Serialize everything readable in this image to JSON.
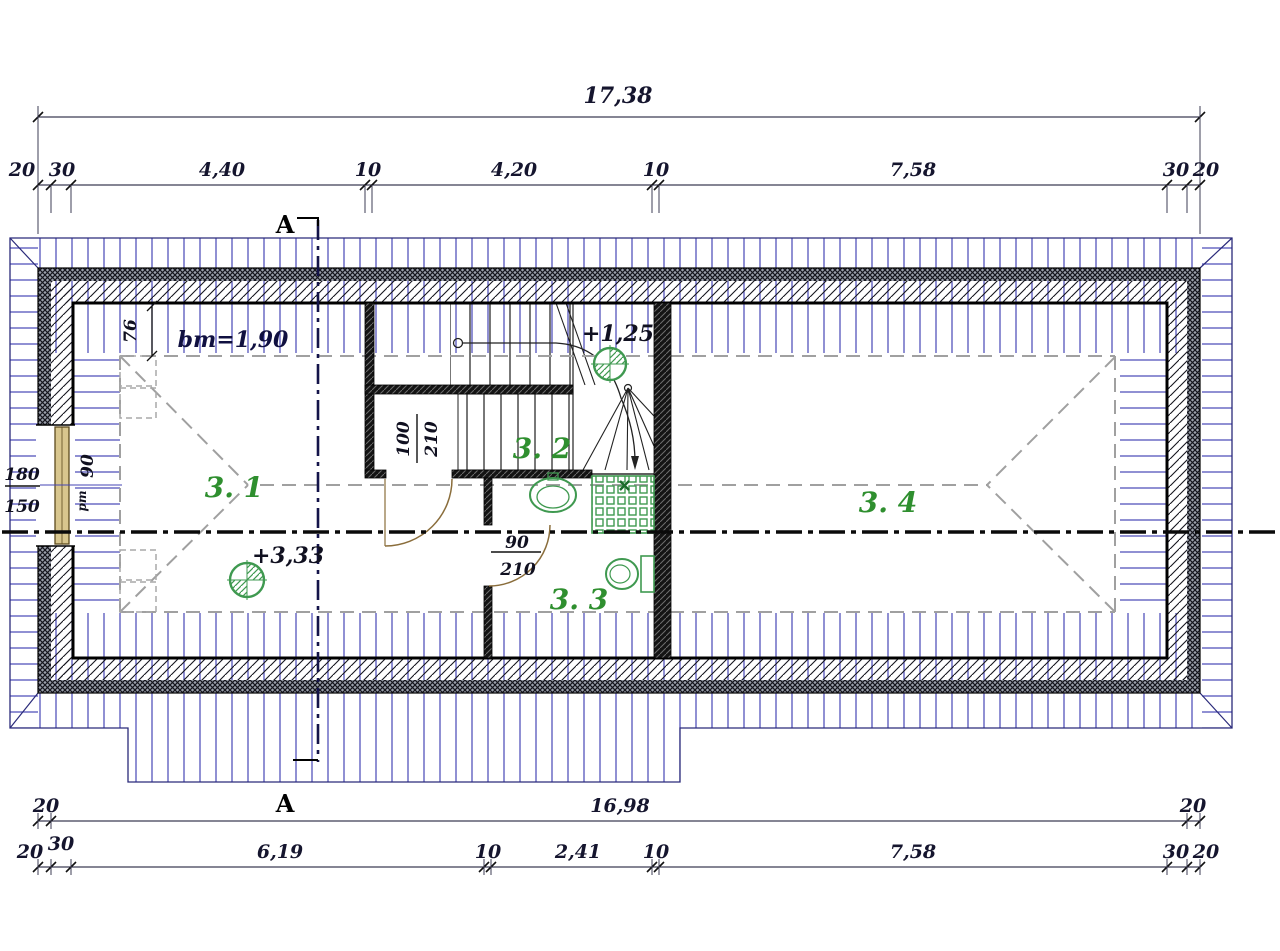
{
  "dimensions": {
    "top_total": "17,38",
    "top_chain": [
      "20",
      "30",
      "4,40",
      "10",
      "4,20",
      "10",
      "7,58",
      "30",
      "20"
    ],
    "bottom_row": [
      "20",
      "16,98",
      "20"
    ],
    "bottom_chain": [
      "20",
      "30",
      "6,19",
      "10",
      "2,41",
      "10",
      "7,58",
      "30",
      "20"
    ]
  },
  "section": {
    "label_top": "A",
    "label_bottom": "A"
  },
  "rooms": [
    {
      "label": "3. 1"
    },
    {
      "label": "3. 2"
    },
    {
      "label": "3. 3"
    },
    {
      "label": "3. 4"
    }
  ],
  "levels": {
    "attic_floor": "+3,33",
    "stair_landing": "+1,25"
  },
  "annotations": {
    "min_headroom": "bm=1,90",
    "headroom_band_width": "76",
    "window": {
      "width": "180",
      "height": "150",
      "parapet": "90",
      "parapet_prefix": "pm"
    },
    "stair_door": {
      "width": "100",
      "height": "210"
    },
    "bath_door": {
      "width": "90",
      "height": "210"
    }
  },
  "colors": {
    "roof_hatch_blue": "#4545b5",
    "outline_blue": "#2a2a7a",
    "fixture_green": "#3f9950",
    "room_label_green": "#2f8f2f",
    "door_arc_tan": "#8a6d3b",
    "window_frame_tan": "#d8c68e",
    "guide_dash_gray": "#a0a0a0",
    "wall_dark": "#141414"
  }
}
